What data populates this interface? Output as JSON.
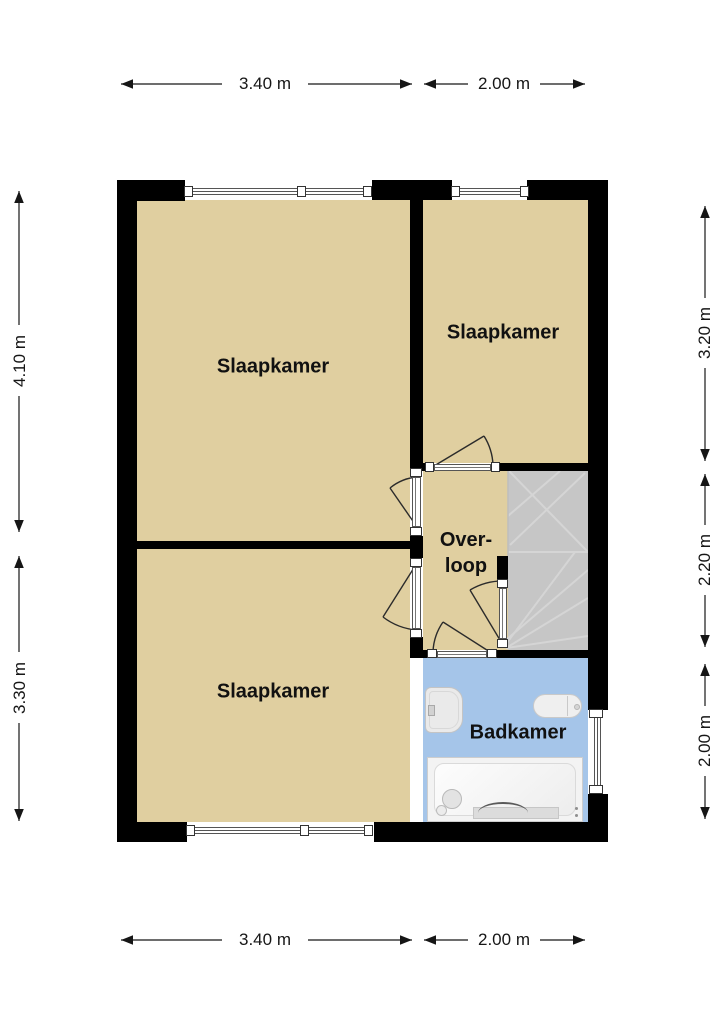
{
  "plan_title": "First floor plan",
  "rooms": [
    {
      "id": "slaapkamer-top-left",
      "label": "Slaapkamer"
    },
    {
      "id": "slaapkamer-top-right",
      "label": "Slaapkamer"
    },
    {
      "id": "slaapkamer-bottom-left",
      "label": "Slaapkamer"
    },
    {
      "id": "overloop",
      "label_line1": "Over-",
      "label_line2": "loop"
    },
    {
      "id": "badkamer",
      "label": "Badkamer"
    }
  ],
  "dimensions": {
    "top": [
      {
        "label": "3.40 m"
      },
      {
        "label": "2.00 m"
      }
    ],
    "bottom": [
      {
        "label": "3.40 m"
      },
      {
        "label": "2.00 m"
      }
    ],
    "left": [
      {
        "label": "4.10 m"
      },
      {
        "label": "3.30 m"
      }
    ],
    "right": [
      {
        "label": "3.20 m"
      },
      {
        "label": "2.20 m"
      },
      {
        "label": "2.00 m"
      }
    ]
  },
  "fixtures": [
    {
      "name": "washbasin"
    },
    {
      "name": "toilet"
    },
    {
      "name": "bathtub"
    },
    {
      "name": "shower-head"
    },
    {
      "name": "winder-stairs"
    }
  ],
  "colors": {
    "floor": "#e0cfa0",
    "bathroom_floor": "#a5c5e9",
    "stairs": "#c6c6c6",
    "wall": "#000000",
    "dimension": "#161616"
  }
}
